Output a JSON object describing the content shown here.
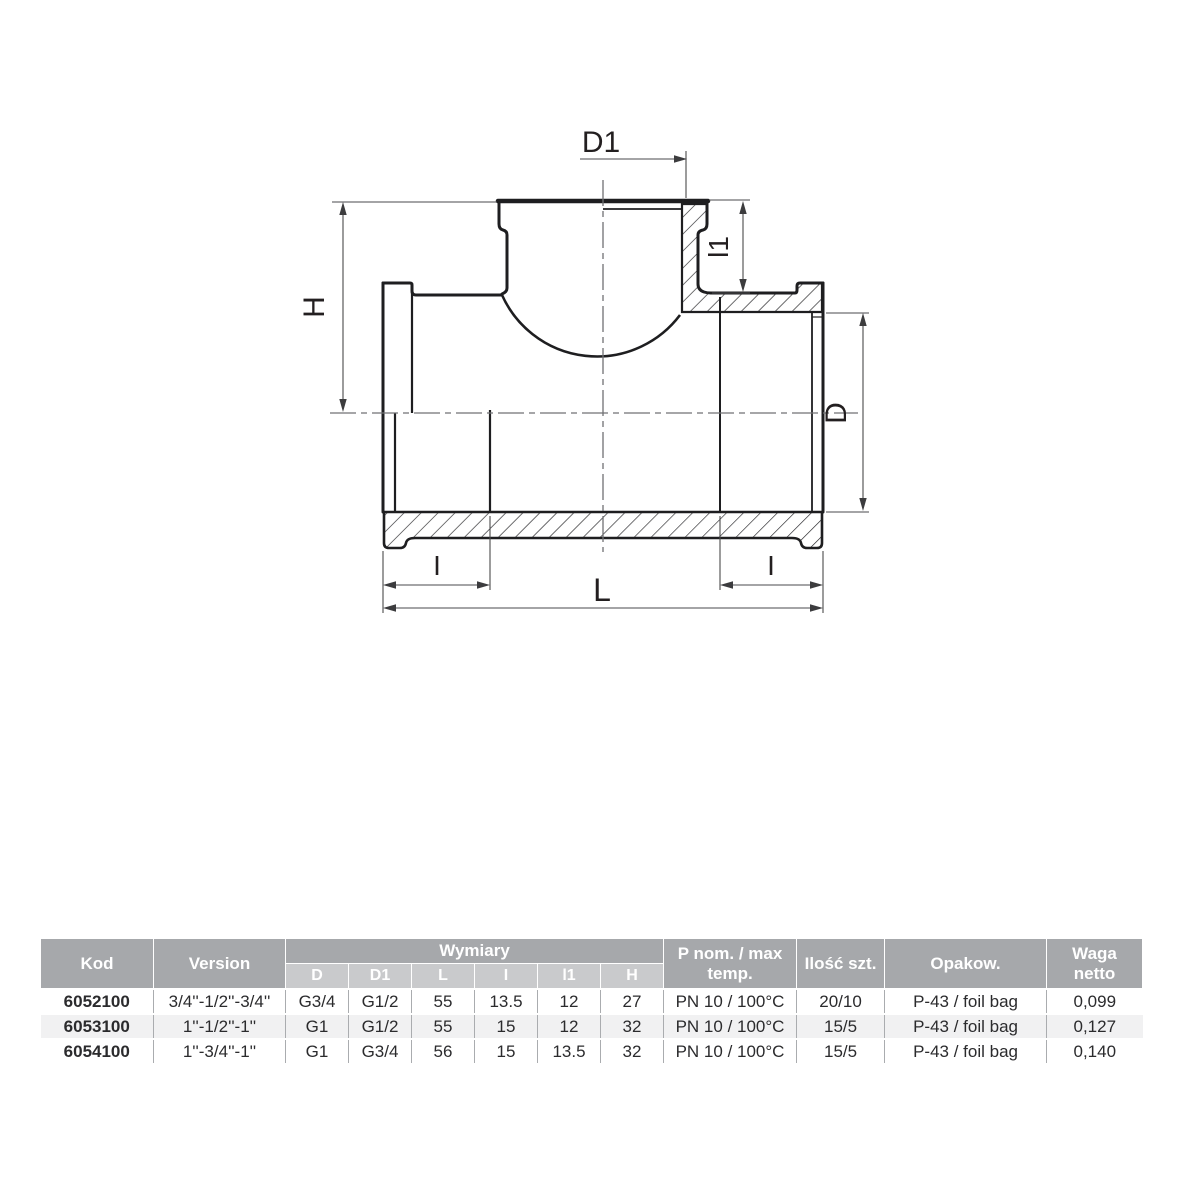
{
  "drawing": {
    "title": "reducing-tee-cross-section",
    "labels": {
      "d1": "D1",
      "l1": "l1",
      "h": "H",
      "d": "D",
      "i_left": "I",
      "i_right": "I",
      "l": "L"
    }
  },
  "colors": {
    "header_gray": "#a6a8ab",
    "subheader_gray": "#c9cacc",
    "row_alt": "#f1f1f2",
    "line_black": "#1e1e20",
    "centerline_gray": "#707174"
  },
  "table": {
    "headers": {
      "kod": "Kod",
      "version": "Version",
      "wymiary": "Wymiary",
      "dims": [
        "D",
        "D1",
        "L",
        "I",
        "l1",
        "H"
      ],
      "pnom": "P nom. / max temp.",
      "ilosc": "Ilość szt.",
      "opakow": "Opakow.",
      "waga": "Waga netto"
    },
    "rows": [
      {
        "kod": "6052100",
        "version": "3/4''-1/2''-3/4''",
        "d": "G3/4",
        "d1": "G1/2",
        "l": "55",
        "i": "13.5",
        "l1": "12",
        "h": "27",
        "pnom": "PN 10 / 100°C",
        "ilosc": "20/10",
        "opakow": "P-43 / foil bag",
        "waga": "0,099"
      },
      {
        "kod": "6053100",
        "version": "1''-1/2''-1''",
        "d": "G1",
        "d1": "G1/2",
        "l": "55",
        "i": "15",
        "l1": "12",
        "h": "32",
        "pnom": "PN 10 / 100°C",
        "ilosc": "15/5",
        "opakow": "P-43 / foil bag",
        "waga": "0,127"
      },
      {
        "kod": "6054100",
        "version": "1''-3/4''-1''",
        "d": "G1",
        "d1": "G3/4",
        "l": "56",
        "i": "15",
        "l1": "13.5",
        "h": "32",
        "pnom": "PN 10 / 100°C",
        "ilosc": "15/5",
        "opakow": "P-43 / foil bag",
        "waga": "0,140"
      }
    ]
  }
}
